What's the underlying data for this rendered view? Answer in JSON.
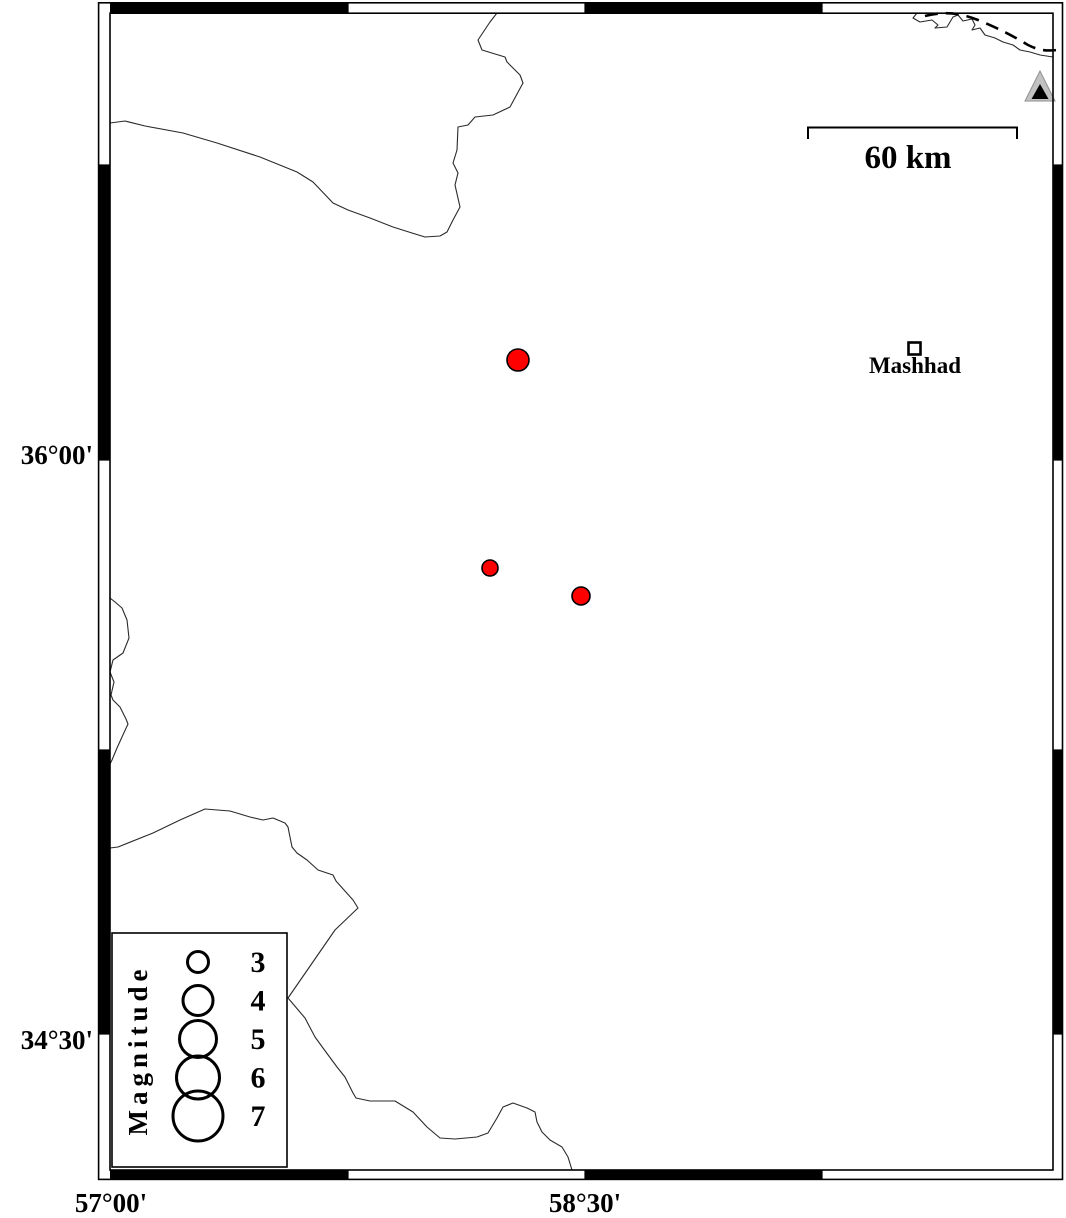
{
  "colors": {
    "background": "#ffffff",
    "event_fill": "#ff0000",
    "event_outline": "#000000",
    "station_gray": "#c2c2c2",
    "station_inner": "#000000",
    "frame_black": "#000000"
  },
  "map": {
    "axis": {
      "lat_ticks": [
        {
          "label": "36°00'",
          "y_px": 455
        },
        {
          "label": "34°30'",
          "y_px": 1040
        }
      ],
      "lon_ticks": [
        {
          "label": "57°00'",
          "x_px": 111
        },
        {
          "label": "58°30'",
          "x_px": 585
        }
      ]
    },
    "scale_bar": {
      "label": "60 km",
      "represents_km": 60,
      "length_px": 209
    },
    "city": {
      "label": "Mashhad",
      "x_px": 915,
      "y_px": 348
    },
    "station": {
      "marker": "gray-triangle",
      "x_px": 1040,
      "y_px": 93
    },
    "legend": {
      "title": "Magnitude",
      "items": [
        {
          "label": "3",
          "radius_px": 10.5
        },
        {
          "label": "4",
          "radius_px": 15
        },
        {
          "label": "5",
          "radius_px": 18.5
        },
        {
          "label": "6",
          "radius_px": 21.5
        },
        {
          "label": "7",
          "radius_px": 25
        }
      ]
    },
    "events": [
      {
        "x_px": 518,
        "y_px": 360,
        "radius_px": 11,
        "lon_approx": "58.29°E",
        "lat_approx": "36.24°N",
        "magnitude_approx": 3.1
      },
      {
        "x_px": 490,
        "y_px": 568,
        "radius_px": 8,
        "lon_approx": "58.20°E",
        "lat_approx": "35.71°N",
        "magnitude_approx": 2.4
      },
      {
        "x_px": 581,
        "y_px": 596,
        "radius_px": 9,
        "lon_approx": "58.49°E",
        "lat_approx": "35.64°N",
        "magnitude_approx": 2.7
      }
    ]
  }
}
